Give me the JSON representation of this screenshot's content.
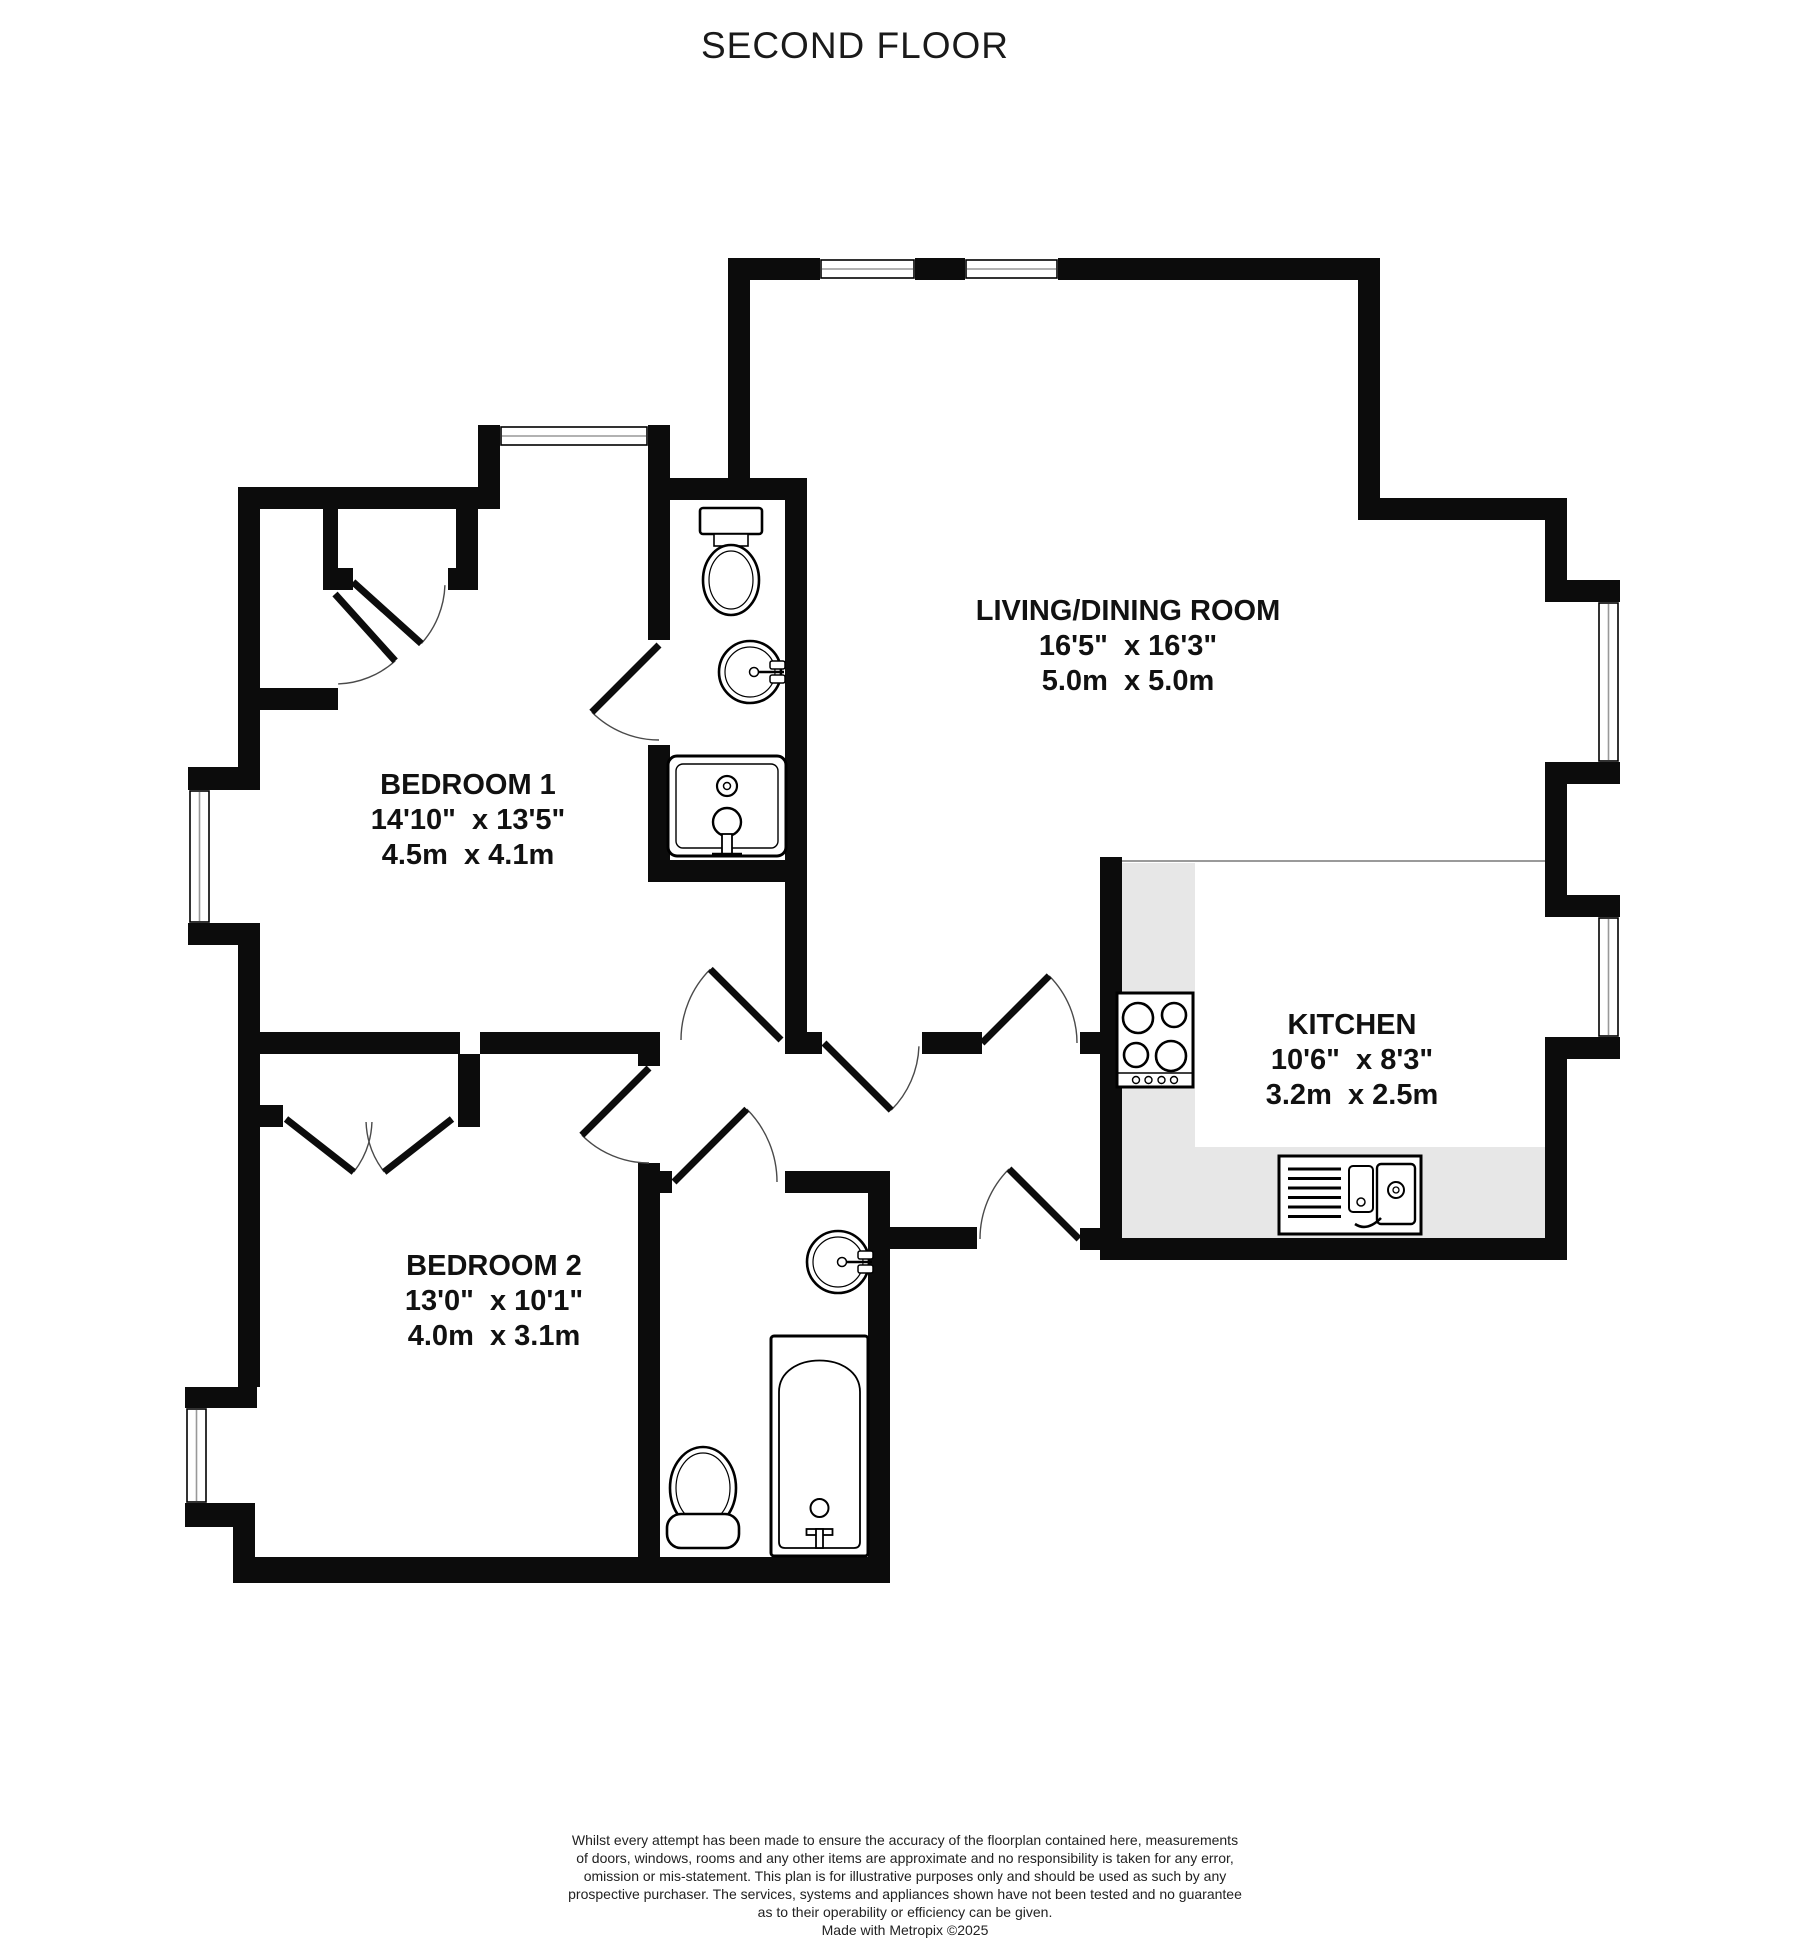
{
  "title": "SECOND FLOOR",
  "rooms": [
    {
      "name": "LIVING/DINING ROOM",
      "imperial": "16'5\"  x 16'3\"",
      "metric": "5.0m  x 5.0m"
    },
    {
      "name": "BEDROOM 1",
      "imperial": "14'10\"  x 13'5\"",
      "metric": "4.5m  x 4.1m"
    },
    {
      "name": "BEDROOM 2",
      "imperial": "13'0\"  x 10'1\"",
      "metric": "4.0m  x 3.1m"
    },
    {
      "name": "KITCHEN",
      "imperial": "10'6\"  x 8'3\"",
      "metric": "3.2m  x 2.5m"
    }
  ],
  "disclaimer": {
    "lines": [
      "Whilst every attempt has been made to ensure the accuracy of the floorplan contained here, measurements",
      "of doors, windows, rooms and any other items are approximate and no responsibility is taken for any error,",
      "omission or mis-statement. This plan is for illustrative purposes only and should be used as such by any",
      "prospective purchaser. The services, systems and appliances shown have not been tested and no guarantee",
      "as to their operability or efficiency can be given."
    ],
    "credit": "Made with Metropix ©2025"
  },
  "colors": {
    "wall": "#0c0c0c",
    "counter": "#e7e7e7",
    "counter_edge": "#9a9a9a",
    "window_mid": "#999999",
    "window_frame": "#000000",
    "arc": "#4a4a4a",
    "fixture": "#000000"
  },
  "floorplan": {
    "walls": [
      [
        740,
        258,
        80,
        22
      ],
      [
        915,
        258,
        50,
        22
      ],
      [
        1058,
        258,
        322,
        22
      ],
      [
        1358,
        258,
        22,
        262
      ],
      [
        1358,
        498,
        209,
        22
      ],
      [
        1545,
        498,
        22,
        104
      ],
      [
        1545,
        580,
        75,
        22
      ],
      [
        1545,
        762,
        75,
        22
      ],
      [
        1545,
        784,
        22,
        133
      ],
      [
        1545,
        895,
        75,
        22
      ],
      [
        1545,
        1037,
        75,
        22
      ],
      [
        1545,
        1059,
        22,
        201
      ],
      [
        1100,
        1238,
        467,
        22
      ],
      [
        1100,
        857,
        22,
        393
      ],
      [
        1080,
        1032,
        20,
        22
      ],
      [
        728,
        258,
        22,
        242
      ],
      [
        648,
        478,
        159,
        22
      ],
      [
        648,
        425,
        22,
        53
      ],
      [
        478,
        425,
        22,
        84
      ],
      [
        238,
        487,
        262,
        22
      ],
      [
        238,
        487,
        22,
        280
      ],
      [
        188,
        767,
        72,
        23
      ],
      [
        188,
        923,
        72,
        22
      ],
      [
        238,
        945,
        22,
        87
      ],
      [
        238,
        1032,
        222,
        22
      ],
      [
        458,
        1054,
        22,
        73
      ],
      [
        480,
        1032,
        180,
        22
      ],
      [
        785,
        1032,
        37,
        22
      ],
      [
        922,
        1032,
        60,
        22
      ],
      [
        648,
        500,
        22,
        140
      ],
      [
        648,
        745,
        22,
        115
      ],
      [
        785,
        500,
        22,
        532
      ],
      [
        648,
        860,
        159,
        22
      ],
      [
        638,
        1054,
        22,
        12
      ],
      [
        638,
        1163,
        22,
        420
      ],
      [
        785,
        1171,
        105,
        22
      ],
      [
        638,
        1171,
        34,
        22
      ],
      [
        868,
        1171,
        22,
        412
      ],
      [
        890,
        1227,
        87,
        22
      ],
      [
        1080,
        1228,
        42,
        22
      ],
      [
        233,
        1557,
        657,
        26
      ],
      [
        185,
        1503,
        70,
        24
      ],
      [
        233,
        1503,
        22,
        80
      ],
      [
        185,
        1387,
        72,
        21
      ],
      [
        238,
        1050,
        22,
        337
      ],
      [
        260,
        1105,
        23,
        22
      ],
      [
        323,
        509,
        15,
        81
      ],
      [
        456,
        509,
        22,
        81
      ],
      [
        323,
        568,
        30,
        22
      ],
      [
        448,
        568,
        30,
        22
      ],
      [
        260,
        688,
        78,
        22
      ]
    ],
    "windows": [
      {
        "x": 820,
        "y": 258,
        "w": 95,
        "h": 22,
        "o": "h"
      },
      {
        "x": 965,
        "y": 258,
        "w": 93,
        "h": 22,
        "o": "h"
      },
      {
        "x": 500,
        "y": 425,
        "w": 148,
        "h": 22,
        "o": "h"
      },
      {
        "x": 1597,
        "y": 602,
        "w": 23,
        "h": 160,
        "o": "v"
      },
      {
        "x": 1597,
        "y": 917,
        "w": 23,
        "h": 120,
        "o": "v"
      },
      {
        "x": 188,
        "y": 790,
        "w": 23,
        "h": 133,
        "o": "v"
      },
      {
        "x": 185,
        "y": 1408,
        "w": 23,
        "h": 95,
        "o": "v"
      }
    ],
    "doors": [
      {
        "name": "ensuite-door",
        "hx": 659,
        "hy": 645,
        "r": 95,
        "leaf": 135,
        "a1": 135,
        "a2": 90
      },
      {
        "name": "bedroom1-door",
        "hx": 781,
        "hy": 1040,
        "r": 100,
        "leaf": 225,
        "a1": 225,
        "a2": 180
      },
      {
        "name": "living-room-door",
        "hx": 824,
        "hy": 1043,
        "r": 95,
        "leaf": 45,
        "a1": 45,
        "a2": 2
      },
      {
        "name": "kitchen-door",
        "hx": 982,
        "hy": 1043,
        "r": 95,
        "leaf": -45,
        "a1": -45,
        "a2": 0
      },
      {
        "name": "entrance-door",
        "hx": 1079,
        "hy": 1239,
        "r": 99,
        "leaf": 225,
        "a1": 225,
        "a2": 180
      },
      {
        "name": "bathroom-door",
        "hx": 674,
        "hy": 1182,
        "r": 103,
        "leaf": -45,
        "a1": -45,
        "a2": 0
      },
      {
        "name": "bedroom2-door",
        "hx": 649,
        "hy": 1068,
        "r": 95,
        "leaf": 135,
        "a1": 135,
        "a2": 90
      },
      {
        "name": "closet-door-a",
        "hx": 353,
        "hy": 582,
        "r": 92,
        "leaf": 42,
        "a1": 42,
        "a2": 2
      },
      {
        "name": "closet-door-b",
        "hx": 335,
        "hy": 594,
        "r": 90,
        "leaf": 48,
        "a1": 48,
        "a2": 88
      },
      {
        "name": "wardrobe-door-left",
        "hx": 286,
        "hy": 1119,
        "r": 86,
        "leaf": 38,
        "a1": 38,
        "a2": 2
      },
      {
        "name": "wardrobe-door-right",
        "hx": 452,
        "hy": 1119,
        "r": 86,
        "leaf": 142,
        "a1": 142,
        "a2": 178
      }
    ],
    "counters": [
      [
        1122,
        863,
        73,
        284
      ],
      [
        1122,
        1147,
        423,
        91
      ]
    ],
    "open_plan_line": {
      "x1": 1122,
      "y": 861,
      "x2": 1545
    },
    "fixtures": [
      {
        "type": "toilet-top",
        "x": 731,
        "y": 508
      },
      {
        "type": "basin",
        "x": 750,
        "y": 672
      },
      {
        "type": "shower-sink",
        "x": 668,
        "y": 756,
        "w": 118,
        "h": 100
      },
      {
        "type": "toilet-front",
        "x": 703,
        "y": 1488
      },
      {
        "type": "basin",
        "x": 838,
        "y": 1262
      },
      {
        "type": "bathtub",
        "x": 771,
        "y": 1336,
        "w": 97,
        "h": 220
      },
      {
        "type": "hob",
        "x": 1117,
        "y": 993,
        "w": 76,
        "h": 94
      },
      {
        "type": "kitchen-sink",
        "x": 1279,
        "y": 1156,
        "w": 142,
        "h": 78
      }
    ]
  }
}
